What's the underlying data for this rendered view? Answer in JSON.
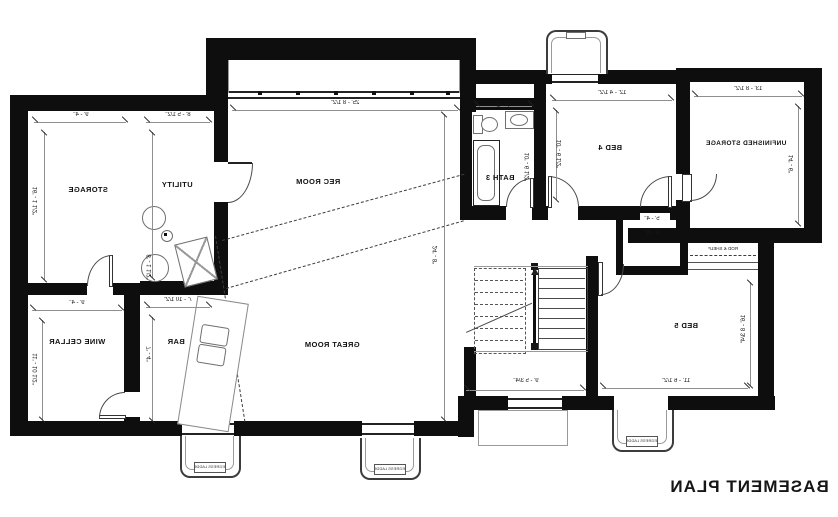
{
  "title": "BASEMENT PLAN",
  "rooms": {
    "storage": "STORAGE",
    "utility": "UTILITY",
    "rec_room": "REC ROOM",
    "great_room": "GREAT ROOM",
    "wine_cellar": "WINE CELLAR",
    "bar": "BAR",
    "bath3": "BATH 3",
    "bed4": "BED 4",
    "unfinished_storage": "UNFINISHED STORAGE",
    "bed5": "BED 5"
  },
  "annotations": {
    "egress_ladder": "EGRESS LADDER",
    "rod_shelf": "ROD & SHELF"
  },
  "dimensions": {
    "rec_w": "25' - 8 1/2\"",
    "rec_h": "24' - 8\"",
    "storage_w": "9' - 4\"",
    "storage_h": "16' - 1 1/2\"",
    "utility_w": "8' - 5 1/2\"",
    "utility_h": "8' - 1 1/2\"",
    "wine_w": "9' - 4\"",
    "wine_h": "11' - 10 1/2\"",
    "bar_w": "7' - 10 1/2\"",
    "bar_h": "7' - 4\"",
    "bath_w": "7' - 2\"",
    "bath_h": "10' - 6 1/2\"",
    "bed4_w": "12' - 4 1/2\"",
    "bed4_h": "10' - 6 1/2\"",
    "unf_w": "13' - 8 1/2\"",
    "unf_h": "14' - 6\"",
    "bed5_w": "11' - 6 1/2\"",
    "bed5_h": "16' - 8 3/4\"",
    "stairs_w": "9' - 5 3/4\"",
    "closet_a": "5' - 4\"",
    "closet_b": "2' - 8\""
  },
  "colors": {
    "wall": "#0e0e0e",
    "extension_line": "#8f8f8f",
    "fixture_line": "#6f6f6f",
    "text": "#1a1a1a",
    "background": "#ffffff"
  }
}
